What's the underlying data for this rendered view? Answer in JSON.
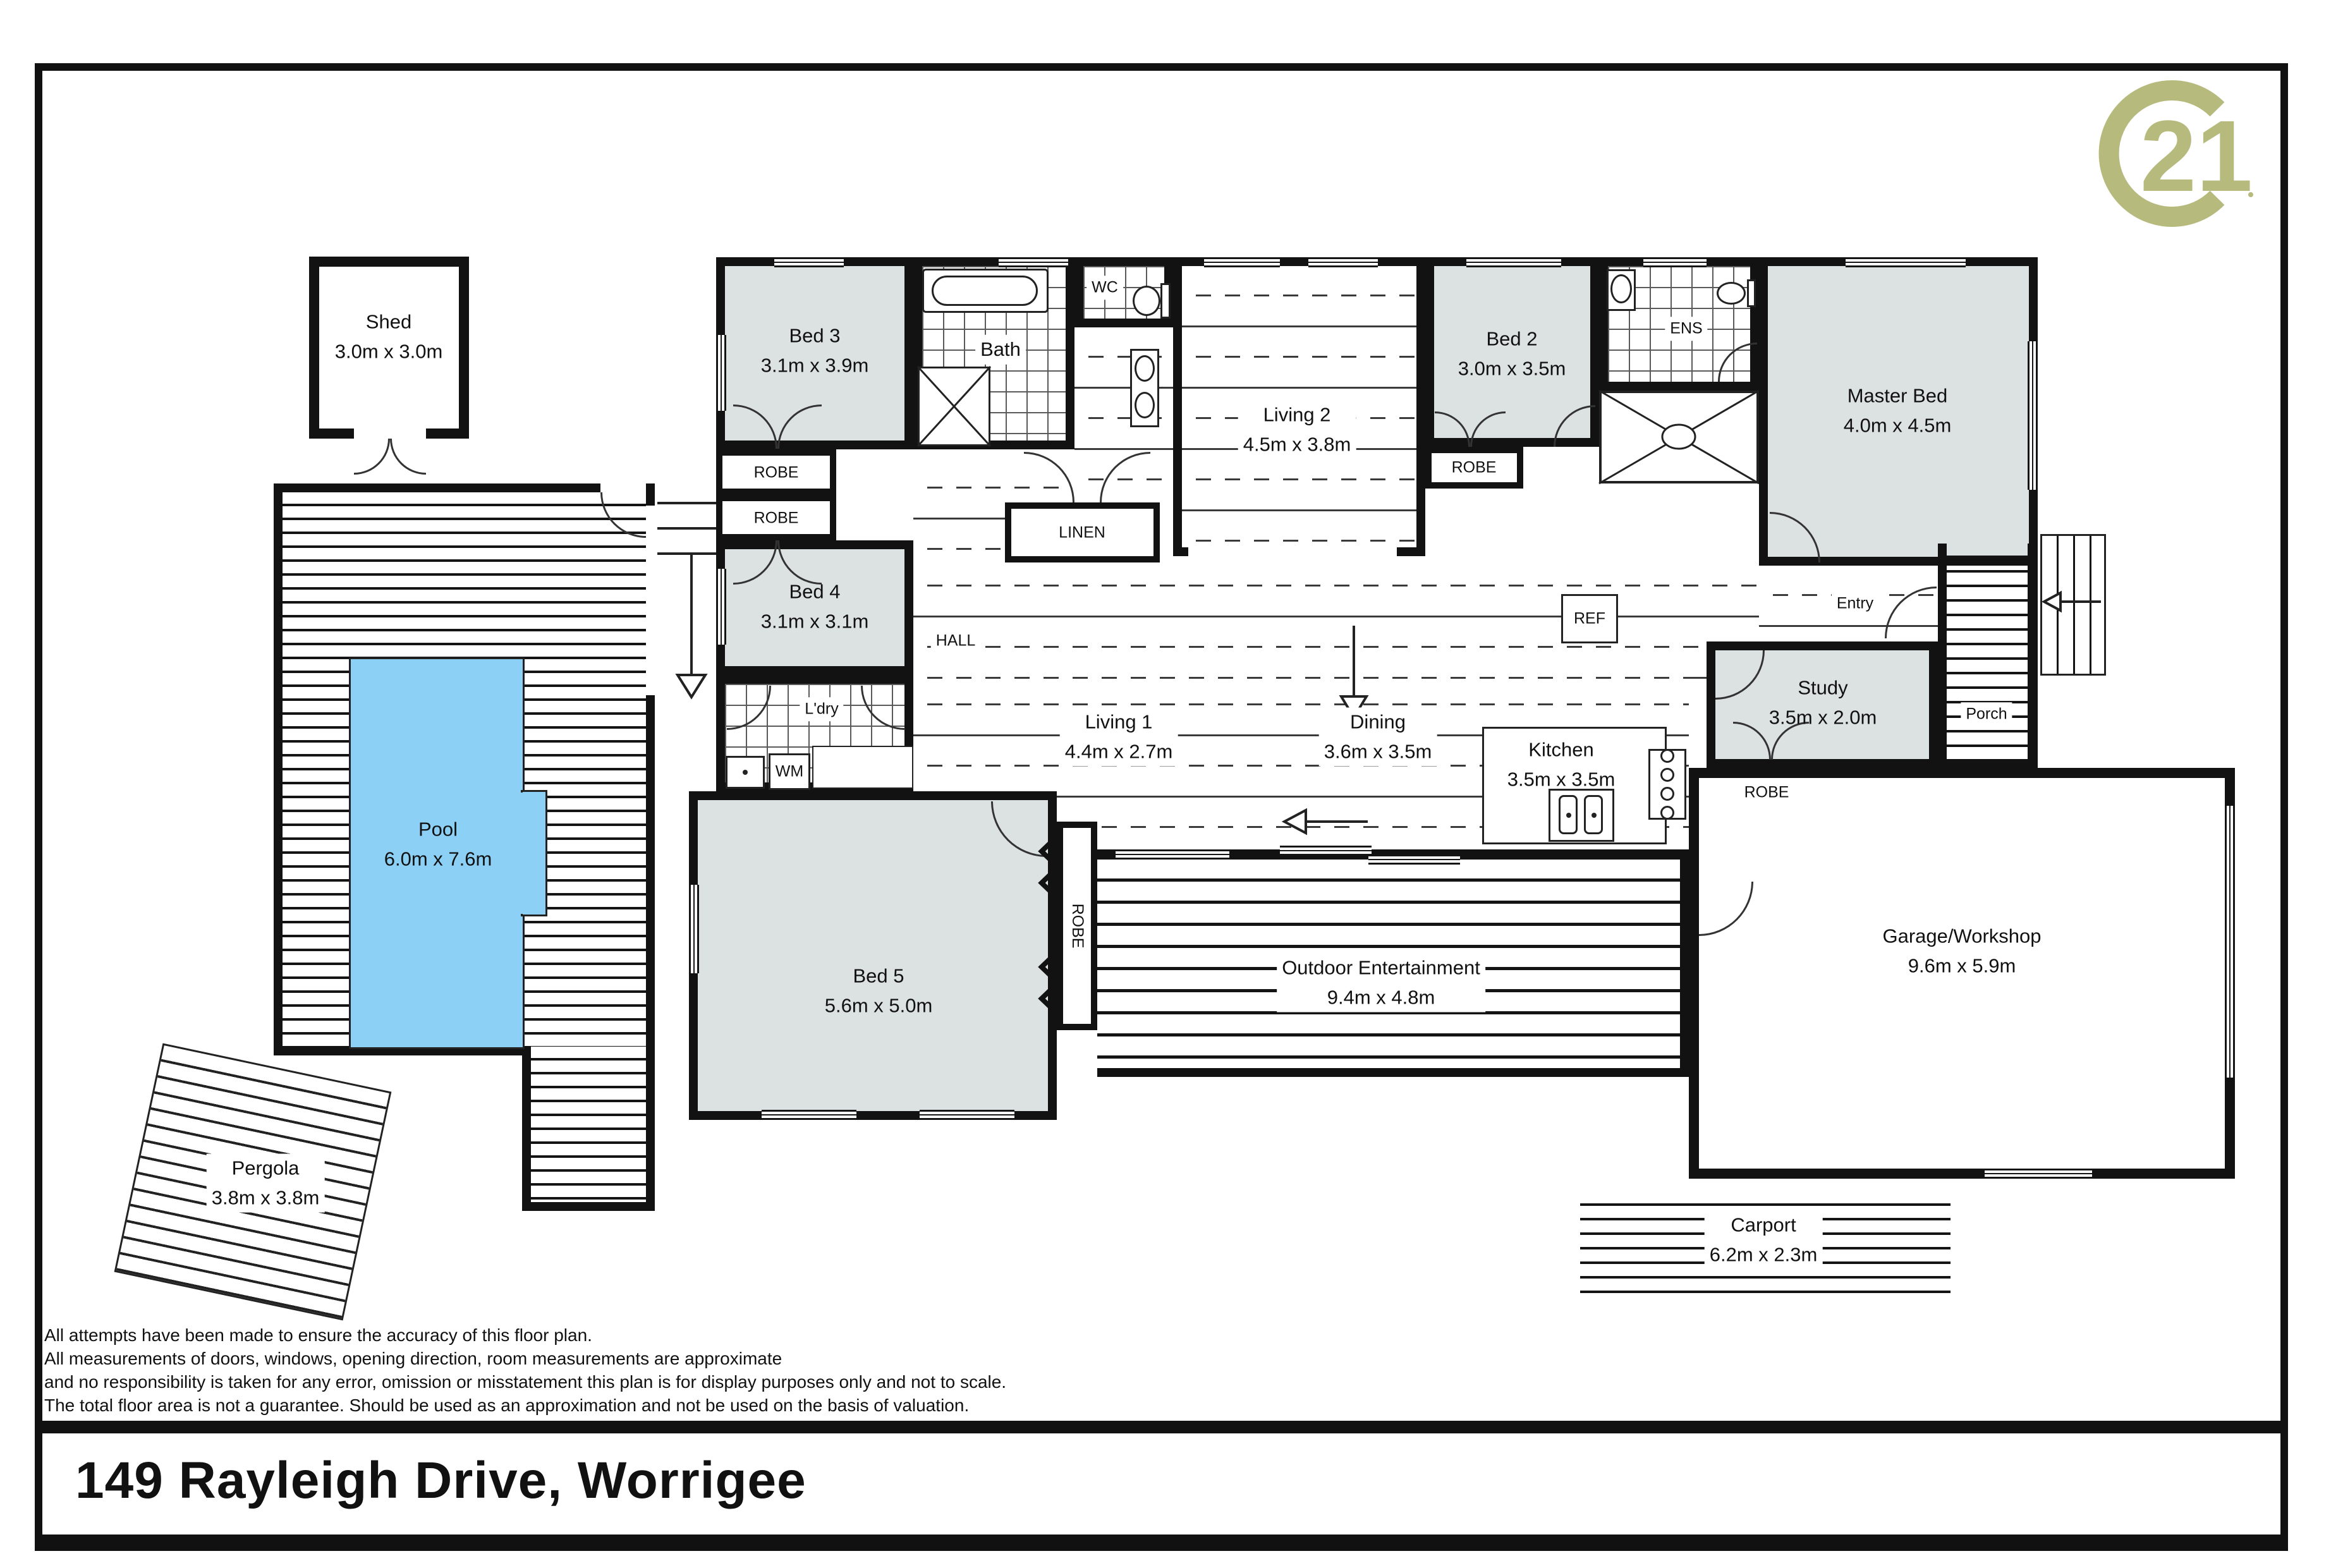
{
  "meta": {
    "address": "149 Rayleigh Drive, Worrigee"
  },
  "brand": {
    "name": "Century 21",
    "logo_text": "21",
    "logo_color": "#b7ba7d"
  },
  "disclaimer": {
    "lines": [
      "All attempts have been made to ensure the accuracy of this floor plan.",
      "All measurements of doors, windows, opening direction, room measurements are approximate",
      "and no responsibility is taken for any error, omission or misstatement this plan is for display purposes only and not to scale.",
      "The total floor area is not a guarantee. Should be used as an approximation and not be used on the basis of valuation."
    ]
  },
  "labels": {
    "robe": "ROBE",
    "linen": "LINEN",
    "hall": "HALL",
    "entry": "Entry",
    "porch": "Porch",
    "wm": "WM",
    "ref": "REF",
    "ldry": "L'dry",
    "bath": "Bath",
    "wc": "WC",
    "ens": "ENS"
  },
  "rooms": {
    "shed": {
      "name": "Shed",
      "dims": "3.0m x 3.0m"
    },
    "pool": {
      "name": "Pool",
      "dims": "6.0m x 7.6m"
    },
    "pergola": {
      "name": "Pergola",
      "dims": "3.8m x 3.8m"
    },
    "bed3": {
      "name": "Bed 3",
      "dims": "3.1m x 3.9m"
    },
    "bed4": {
      "name": "Bed 4",
      "dims": "3.1m x 3.1m"
    },
    "bed5": {
      "name": "Bed 5",
      "dims": "5.6m x 5.0m"
    },
    "bed2": {
      "name": "Bed 2",
      "dims": "3.0m x 3.5m"
    },
    "master": {
      "name": "Master Bed",
      "dims": "4.0m x 4.5m"
    },
    "living1": {
      "name": "Living 1",
      "dims": "4.4m x 2.7m"
    },
    "living2": {
      "name": "Living 2",
      "dims": "4.5m x 3.8m"
    },
    "dining": {
      "name": "Dining",
      "dims": "3.6m x 3.5m"
    },
    "kitchen": {
      "name": "Kitchen",
      "dims": "3.5m x 3.5m"
    },
    "study": {
      "name": "Study",
      "dims": "3.5m x 2.0m"
    },
    "outdoor": {
      "name": "Outdoor Entertainment",
      "dims": "9.4m x 4.8m"
    },
    "garage": {
      "name": "Garage/Workshop",
      "dims": "9.6m x 5.9m"
    },
    "carport": {
      "name": "Carport",
      "dims": "6.2m x 2.3m"
    }
  },
  "colors": {
    "pool_fill": "#8dd0f6",
    "room_fill": "#dce1e1",
    "wall": "#121212",
    "logo": "#b7ba7d"
  }
}
